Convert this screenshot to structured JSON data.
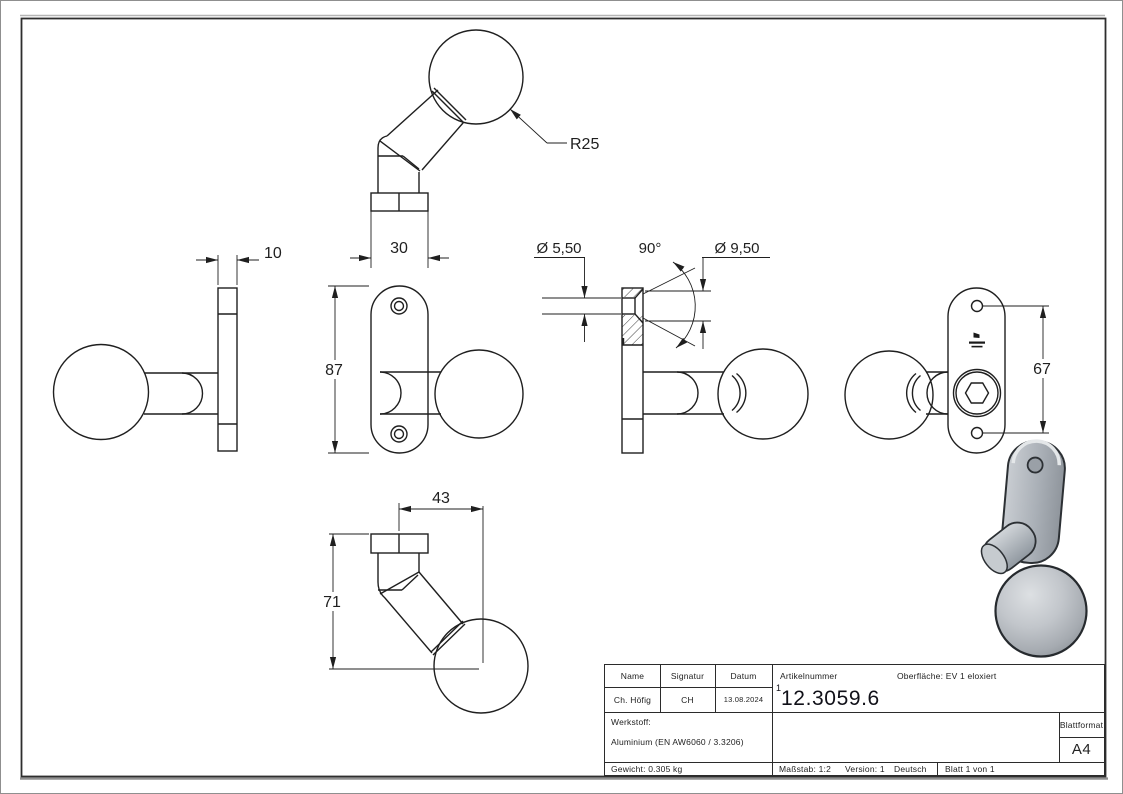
{
  "drawing": {
    "dimensions": {
      "ball_radius": "R25",
      "plate_thickness": "10",
      "plate_width": "30",
      "plate_height": "87",
      "hole_diameter": "Ø 5,50",
      "countersink_angle": "90°",
      "countersink_diameter": "Ø 9,50",
      "hole_spacing": "67",
      "projection_width": "43",
      "projection_height": "71"
    }
  },
  "title_block": {
    "name_label": "Name",
    "signatur_label": "Signatur",
    "datum_label": "Datum",
    "name_value": "Ch. Höfig",
    "signatur_value": "CH",
    "datum_value": "13.08.2024",
    "artikelnummer_label": "Artikelnummer",
    "artikelnummer_prefix": "1",
    "artikelnummer_value": "12.3059.6",
    "oberflaeche": "Oberfläche:  EV 1 eloxiert",
    "werkstoff_label": "Werkstoff:",
    "werkstoff_value": "Aluminium (EN AW6060 / 3.3206)",
    "blattformat_label": "Blattformat",
    "blattformat_value": "A4",
    "gewicht": "Gewicht: 0.305 kg",
    "massstab": "Maßstab: 1:2",
    "version": "Version: 1",
    "sprache": "Deutsch",
    "blatt": "Blatt 1 von 1"
  },
  "colors": {
    "line": "#1f1f1f",
    "frame": "#2e2e2e",
    "render_light": "#dde0e3",
    "render_mid": "#b9bec4",
    "render_dark": "#8b9197"
  }
}
